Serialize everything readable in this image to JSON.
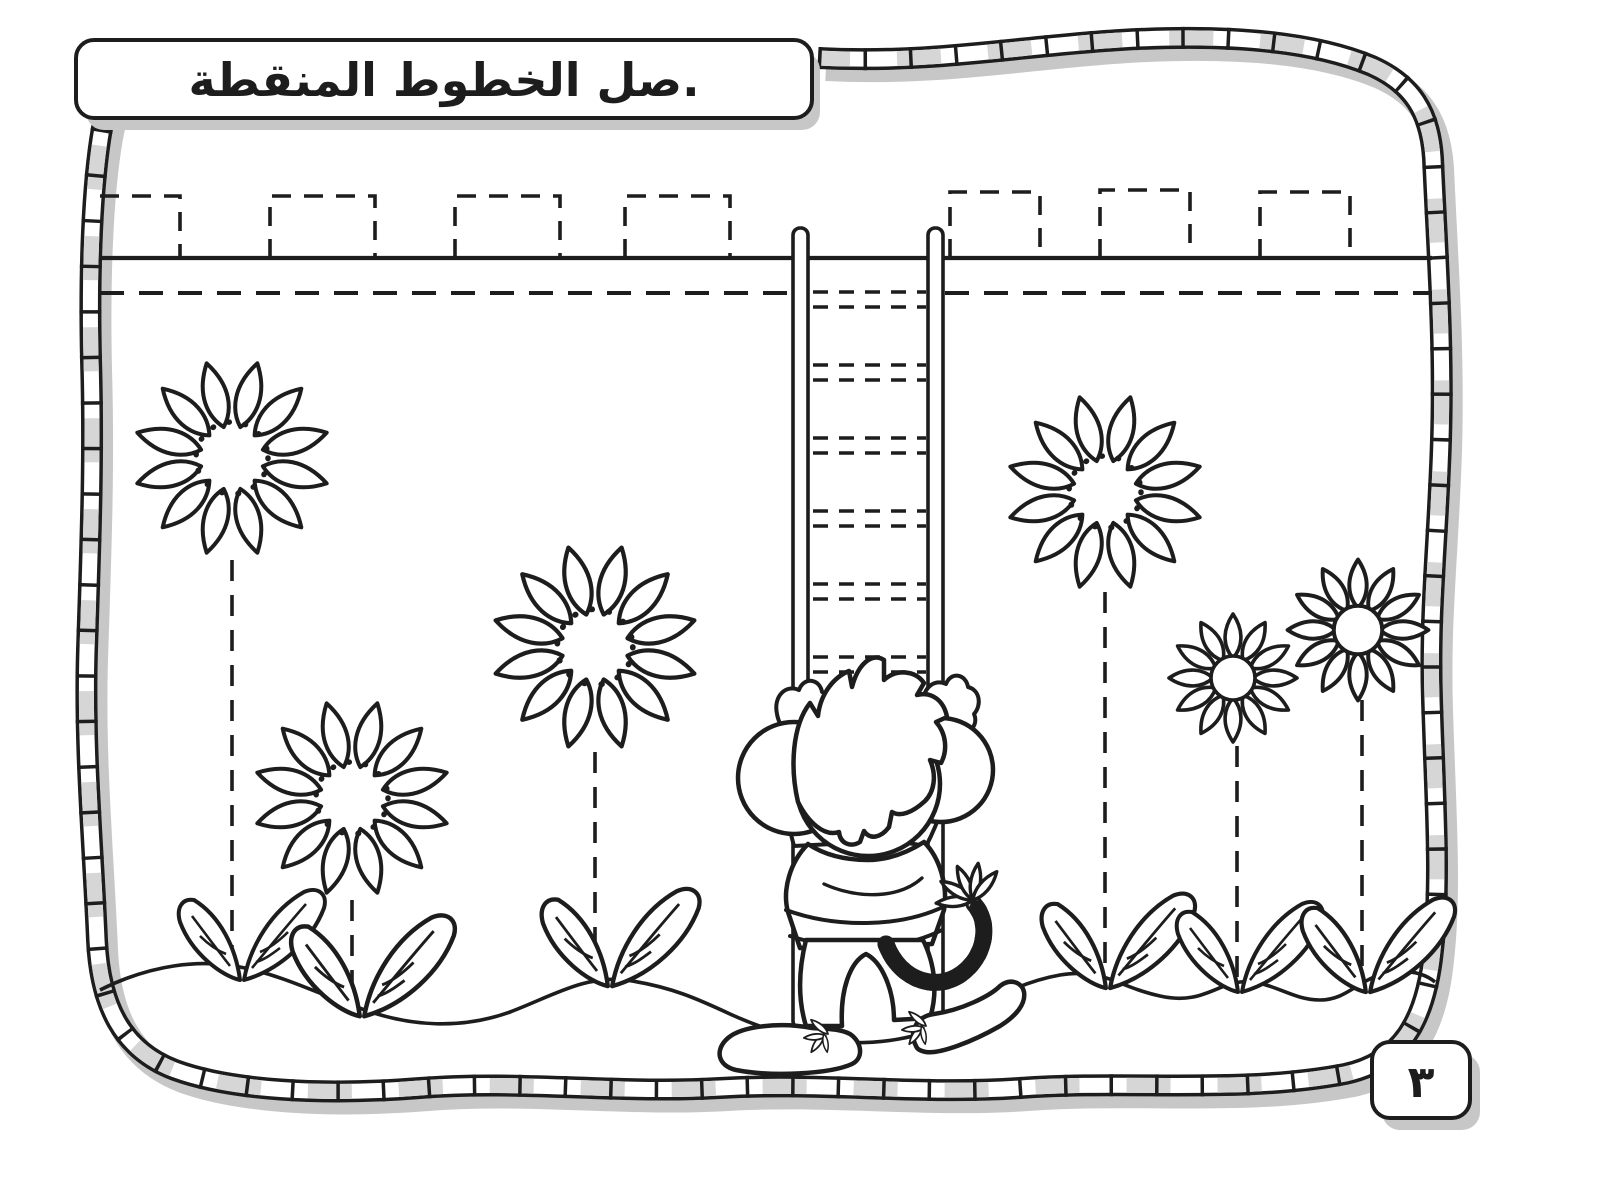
{
  "document": {
    "instruction": "صل الخطوط المنقطة.",
    "page_number": "٣"
  },
  "colors": {
    "ink": "#1d1d1d",
    "paper": "#ffffff",
    "shadow": "#c7c7c7",
    "band-gray": "#d6d6d6"
  }
}
